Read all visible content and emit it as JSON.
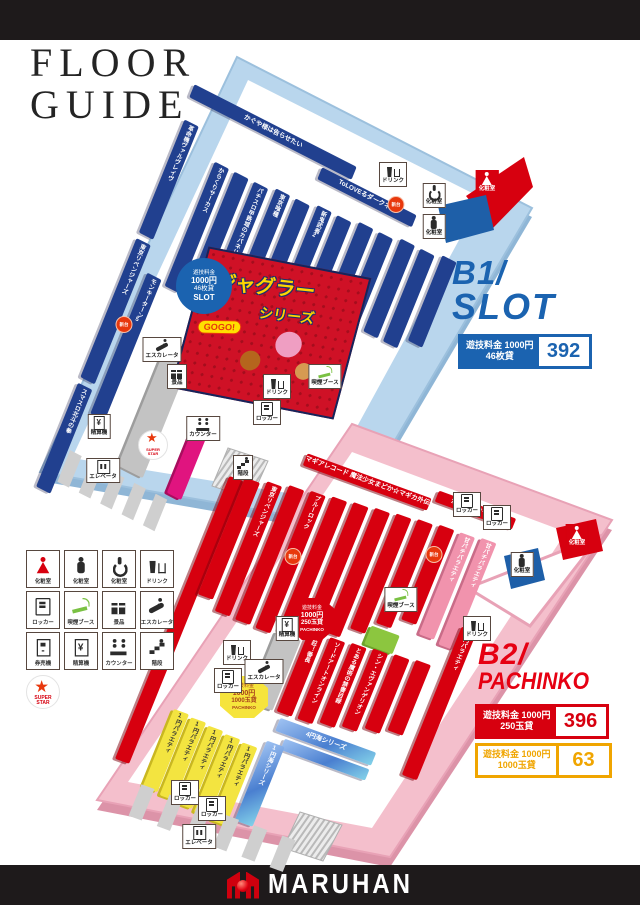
{
  "header": {
    "title_line1": "FLOOR",
    "title_line2": "GUIDE"
  },
  "footer": {
    "brand": "MARUHAN"
  },
  "legend": {
    "items": [
      {
        "icon": "restroom-female-icon",
        "label": "化粧室"
      },
      {
        "icon": "restroom-male-icon",
        "label": "化粧室"
      },
      {
        "icon": "wheelchair-icon",
        "label": "化粧室"
      },
      {
        "icon": "drink-icon",
        "label": "ドリンク"
      },
      {
        "icon": "locker-icon",
        "label": "ロッカー"
      },
      {
        "icon": "smoke-icon",
        "label": "喫煙ブース"
      },
      {
        "icon": "gift-icon",
        "label": "景品"
      },
      {
        "icon": "escalator-icon",
        "label": "エスカレータ"
      },
      {
        "icon": "ticket-icon",
        "label": "券売機"
      },
      {
        "icon": "settle-icon",
        "label": "精算機"
      },
      {
        "icon": "counter-icon",
        "label": "カウンター"
      },
      {
        "icon": "stairs-icon",
        "label": "階段"
      },
      {
        "icon": "star-logo-icon",
        "label": "SUPER STAR",
        "variant": "star"
      }
    ]
  },
  "floors": {
    "b1": {
      "label": "B1/",
      "sublabel": "SLOT",
      "accent_color": "#1b63b0",
      "fee_badge": {
        "fee_line1": "遊技料金 1000円",
        "fee_line2": "46枚貸",
        "machine_count": "392"
      },
      "area_badge": {
        "l1": "遊技料金",
        "l2": "1000円",
        "l3": "46枚貸",
        "l4": "SLOT"
      },
      "poster": {
        "title": "ジャグラー",
        "subtitle": "シリーズ",
        "badge": "GOGO!"
      },
      "rows": [
        {
          "label": "かぐや様は告らせたい",
          "cat": "slot",
          "dir": "h",
          "x": -14,
          "y": -8,
          "w": 182,
          "h": 14
        },
        {
          "label": "ToLOVEるダークネス",
          "cat": "slot",
          "dir": "h",
          "x": 136,
          "y": 8,
          "w": 106,
          "h": 13
        },
        {
          "label": "革命機ヴァルヴレイヴ",
          "cat": "slot",
          "x": -10,
          "y": 28,
          "w": 16,
          "h": 122
        },
        {
          "label": "東京リベンジャーズ",
          "cat": "slot",
          "x": -10,
          "y": 156,
          "w": 16,
          "h": 150
        },
        {
          "label": "スマスロ北斗の拳",
          "cat": "slot",
          "x": -10,
          "y": 312,
          "w": 16,
          "h": 112
        },
        {
          "label": "モンキーターン5",
          "cat": "slot",
          "x": 13,
          "y": 182,
          "w": 16,
          "h": 152
        },
        {
          "label": "からくりサーカス",
          "cat": "slot",
          "x": 34,
          "y": 52,
          "w": 16,
          "h": 134
        },
        {
          "label": "",
          "cat": "slot",
          "x": 56,
          "y": 52,
          "w": 16,
          "h": 134
        },
        {
          "label": "パチスロ甲鉄城のカバネリ",
          "cat": "slot",
          "x": 78,
          "y": 52,
          "w": 16,
          "h": 140
        },
        {
          "label": "東京喰種",
          "cat": "slot",
          "x": 101,
          "y": 48,
          "w": 16,
          "h": 122
        },
        {
          "label": "",
          "cat": "slot",
          "x": 123,
          "y": 48,
          "w": 16,
          "h": 122
        },
        {
          "label": "新鬼武者2",
          "cat": "slot",
          "x": 146,
          "y": 44,
          "w": 16,
          "h": 116
        },
        {
          "label": "",
          "cat": "slot",
          "x": 168,
          "y": 44,
          "w": 16,
          "h": 116
        },
        {
          "label": "",
          "cat": "slot",
          "x": 191,
          "y": 40,
          "w": 16,
          "h": 108
        },
        {
          "label": "",
          "cat": "slot",
          "x": 213,
          "y": 40,
          "w": 16,
          "h": 108
        },
        {
          "label": "",
          "cat": "slot",
          "x": 236,
          "y": 36,
          "w": 16,
          "h": 100
        },
        {
          "label": "",
          "cat": "slot",
          "x": 258,
          "y": 36,
          "w": 16,
          "h": 100
        },
        {
          "label": "",
          "cat": "slot",
          "x": 281,
          "y": 32,
          "w": 16,
          "h": 92
        },
        {
          "label": "新ハナビ",
          "cat": "slot",
          "dir": "h",
          "x": 118,
          "y": 168,
          "w": 80,
          "h": 12
        },
        {
          "label": "",
          "cat": "struct",
          "x": 58,
          "y": 240,
          "w": 28,
          "h": 128
        },
        {
          "label": "",
          "cat": "counter",
          "x": 114,
          "y": 292,
          "w": 16,
          "h": 78
        },
        {
          "label": "",
          "cat": "tooth",
          "x": 8,
          "y": 376,
          "w": 13,
          "h": 34
        },
        {
          "label": "",
          "cat": "tooth",
          "x": 32,
          "y": 376,
          "w": 13,
          "h": 34
        },
        {
          "label": "",
          "cat": "tooth",
          "x": 56,
          "y": 376,
          "w": 13,
          "h": 34
        },
        {
          "label": "",
          "cat": "tooth",
          "x": 80,
          "y": 376,
          "w": 13,
          "h": 34
        },
        {
          "label": "",
          "cat": "tooth",
          "x": 104,
          "y": 376,
          "w": 13,
          "h": 34
        }
      ],
      "markers": [
        {
          "icon": "drink-icon",
          "label": "ドリンク",
          "x": 393,
          "y": 162
        },
        {
          "icon": "restroom-female-icon",
          "label": "化粧室",
          "variant": "red-box",
          "x": 487,
          "y": 170
        },
        {
          "icon": "wheelchair-icon",
          "label": "化粧室",
          "x": 434,
          "y": 183
        },
        {
          "icon": "restroom-male-icon",
          "label": "化粧室",
          "x": 434,
          "y": 214
        },
        {
          "icon": "new-machine-icon",
          "label": "新台",
          "variant": "badge-new",
          "x": 396,
          "y": 196
        },
        {
          "icon": "new-machine-icon",
          "label": "新台",
          "variant": "badge-new",
          "x": 124,
          "y": 316
        },
        {
          "icon": "escalator-icon",
          "label": "エスカレータ",
          "x": 162,
          "y": 337
        },
        {
          "icon": "gift-icon",
          "label": "景品",
          "x": 177,
          "y": 364
        },
        {
          "icon": "drink-icon",
          "label": "ドリンク",
          "x": 277,
          "y": 374
        },
        {
          "icon": "smoke-icon",
          "label": "喫煙ブース",
          "x": 325,
          "y": 364
        },
        {
          "icon": "locker-icon",
          "label": "ロッカー",
          "x": 267,
          "y": 400
        },
        {
          "icon": "counter-icon",
          "label": "カウンター",
          "x": 203,
          "y": 416
        },
        {
          "icon": "star-logo-icon",
          "label": "SUPER STAR",
          "variant": "star",
          "x": 153,
          "y": 430
        },
        {
          "icon": "settle-icon",
          "label": "精算機",
          "x": 99,
          "y": 414
        },
        {
          "icon": "elevator-icon",
          "label": "エレベータ",
          "x": 103,
          "y": 458
        },
        {
          "icon": "stairs-icon",
          "label": "階段",
          "x": 243,
          "y": 455
        }
      ]
    },
    "b2": {
      "label": "B2/",
      "sublabel": "PACHINKO",
      "accent_color": "#e60012",
      "fee_badges": [
        {
          "fee_line1": "遊技料金 1000円",
          "fee_line2": "250玉貸",
          "machine_count": "396"
        },
        {
          "fee_line1": "遊技料金 1000円",
          "fee_line2": "1000玉貸",
          "machine_count": "63"
        }
      ],
      "area_badges": [
        {
          "l1": "遊技料金",
          "l2": "1000円",
          "l3": "250玉貸",
          "l4": "PACHINKO"
        },
        {
          "l1": "遊技料金",
          "l2": "1000円",
          "l3": "1000玉貸",
          "l4": "PACHINKO"
        }
      ],
      "rows": [
        {
          "label": "マギアレコード 魔法少女まどか☆マギカ外伝",
          "cat": "pachi",
          "dir": "h",
          "x": 12,
          "y": 10,
          "w": 132,
          "h": 13
        },
        {
          "label": "からくりサーカス",
          "cat": "pachi",
          "dir": "h",
          "x": 148,
          "y": 0,
          "w": 82,
          "h": 12
        },
        {
          "label": "",
          "cat": "pachi",
          "x": -52,
          "y": 58,
          "w": 15,
          "h": 305
        },
        {
          "label": "",
          "cat": "pachi",
          "x": -37,
          "y": 54,
          "w": 16,
          "h": 126
        },
        {
          "label": "東京リベンジャーズ",
          "cat": "pachi",
          "x": -15,
          "y": 50,
          "w": 16,
          "h": 140
        },
        {
          "label": "",
          "cat": "pachi",
          "x": 7,
          "y": 46,
          "w": 16,
          "h": 145
        },
        {
          "label": "ブルーロック",
          "cat": "pachi",
          "x": 29,
          "y": 44,
          "w": 16,
          "h": 148
        },
        {
          "label": "",
          "cat": "pachi",
          "x": 51,
          "y": 42,
          "w": 16,
          "h": 145
        },
        {
          "label": "",
          "cat": "pachi",
          "x": 73,
          "y": 40,
          "w": 16,
          "h": 140
        },
        {
          "label": "",
          "cat": "pachi",
          "x": 95,
          "y": 38,
          "w": 16,
          "h": 134
        },
        {
          "label": "",
          "cat": "pachi",
          "x": 117,
          "y": 36,
          "w": 16,
          "h": 124
        },
        {
          "label": "",
          "cat": "pachi",
          "x": 139,
          "y": 34,
          "w": 16,
          "h": 112
        },
        {
          "label": "",
          "cat": "pachi",
          "x": 161,
          "y": 32,
          "w": 16,
          "h": 102
        },
        {
          "label": "甘パチバラエティ",
          "cat": "ama",
          "x": 183,
          "y": 32,
          "w": 16,
          "h": 110
        },
        {
          "label": "甘パチバラエティ",
          "cat": "ama",
          "x": 205,
          "y": 30,
          "w": 16,
          "h": 115
        },
        {
          "label": "4円バラエティ",
          "cat": "pachi",
          "x": 220,
          "y": 120,
          "w": 16,
          "h": 160
        },
        {
          "label": "",
          "cat": "green",
          "x": 136,
          "y": 150,
          "w": 30,
          "h": 20
        },
        {
          "label": "",
          "cat": "struct",
          "x": 50,
          "y": 188,
          "w": 26,
          "h": 76
        },
        {
          "label": "押忍！番長",
          "cat": "pachi",
          "x": 80,
          "y": 175,
          "w": 16,
          "h": 88
        },
        {
          "label": "ソードアートオンライン",
          "cat": "pachi",
          "x": 102,
          "y": 175,
          "w": 16,
          "h": 88
        },
        {
          "label": "とある魔術の禁書目録",
          "cat": "pachi",
          "x": 124,
          "y": 173,
          "w": 16,
          "h": 86
        },
        {
          "label": "シン・エヴァンゲリオン",
          "cat": "pachi",
          "x": 146,
          "y": 171,
          "w": 16,
          "h": 84
        },
        {
          "label": "",
          "cat": "pachi",
          "x": 168,
          "y": 169,
          "w": 16,
          "h": 80
        },
        {
          "label": "",
          "cat": "pachi",
          "x": 190,
          "y": 167,
          "w": 16,
          "h": 76
        },
        {
          "label": "4円海シリーズ",
          "cat": "sea",
          "dir": "h",
          "x": 86,
          "y": 268,
          "w": 102,
          "h": 14
        },
        {
          "label": "",
          "cat": "sea",
          "dir": "h",
          "x": 98,
          "y": 286,
          "w": 90,
          "h": 12
        },
        {
          "label": "1円バラエティ",
          "cat": "one-yen",
          "x": -16,
          "y": 296,
          "w": 16,
          "h": 84
        },
        {
          "label": "1円バラエティ",
          "cat": "one-yen",
          "x": 3,
          "y": 298,
          "w": 16,
          "h": 84
        },
        {
          "label": "1円バラエティ",
          "cat": "one-yen",
          "x": 22,
          "y": 300,
          "w": 16,
          "h": 84
        },
        {
          "label": "1円バラエティ",
          "cat": "one-yen",
          "x": 41,
          "y": 302,
          "w": 16,
          "h": 84
        },
        {
          "label": "1円バラエティ",
          "cat": "one-yen",
          "x": 60,
          "y": 304,
          "w": 16,
          "h": 84
        },
        {
          "label": "1円海シリーズ",
          "cat": "sea",
          "x": 82,
          "y": 294,
          "w": 19,
          "h": 86
        },
        {
          "label": "",
          "cat": "tooth",
          "x": -18,
          "y": 378,
          "w": 14,
          "h": 34
        },
        {
          "label": "",
          "cat": "tooth",
          "x": 12,
          "y": 378,
          "w": 14,
          "h": 34
        },
        {
          "label": "",
          "cat": "tooth",
          "x": 42,
          "y": 378,
          "w": 14,
          "h": 34
        },
        {
          "label": "",
          "cat": "tooth",
          "x": 72,
          "y": 378,
          "w": 14,
          "h": 34
        },
        {
          "label": "",
          "cat": "tooth",
          "x": 102,
          "y": 378,
          "w": 14,
          "h": 34
        },
        {
          "label": "",
          "cat": "tooth",
          "x": 132,
          "y": 378,
          "w": 14,
          "h": 34
        }
      ],
      "markers": [
        {
          "icon": "locker-icon",
          "label": "ロッカー",
          "x": 467,
          "y": 492
        },
        {
          "icon": "locker-icon",
          "label": "ロッカー",
          "x": 497,
          "y": 505
        },
        {
          "icon": "restroom-male-icon",
          "label": "化粧室",
          "x": 522,
          "y": 552
        },
        {
          "icon": "restroom-female-icon",
          "label": "化粧室",
          "variant": "red-box",
          "x": 577,
          "y": 524
        },
        {
          "icon": "smoke-icon",
          "label": "喫煙ブース",
          "x": 401,
          "y": 587
        },
        {
          "icon": "drink-icon",
          "label": "ドリンク",
          "x": 477,
          "y": 616
        },
        {
          "icon": "settle-icon",
          "label": "精算機",
          "x": 287,
          "y": 616
        },
        {
          "icon": "new-machine-icon",
          "label": "新台",
          "variant": "badge-new",
          "x": 293,
          "y": 548
        },
        {
          "icon": "new-machine-icon",
          "label": "新台",
          "variant": "badge-new",
          "x": 434,
          "y": 546
        },
        {
          "icon": "drink-icon",
          "label": "ドリンク",
          "x": 237,
          "y": 640
        },
        {
          "icon": "escalator-icon",
          "label": "エスカレータ",
          "x": 264,
          "y": 659
        },
        {
          "icon": "locker-icon",
          "label": "ロッカー",
          "x": 228,
          "y": 668
        },
        {
          "icon": "locker-icon",
          "label": "ロッカー",
          "x": 185,
          "y": 780
        },
        {
          "icon": "locker-icon",
          "label": "ロッカー",
          "x": 212,
          "y": 796
        },
        {
          "icon": "elevator-icon",
          "label": "エレベータ",
          "x": 199,
          "y": 824
        }
      ]
    }
  }
}
